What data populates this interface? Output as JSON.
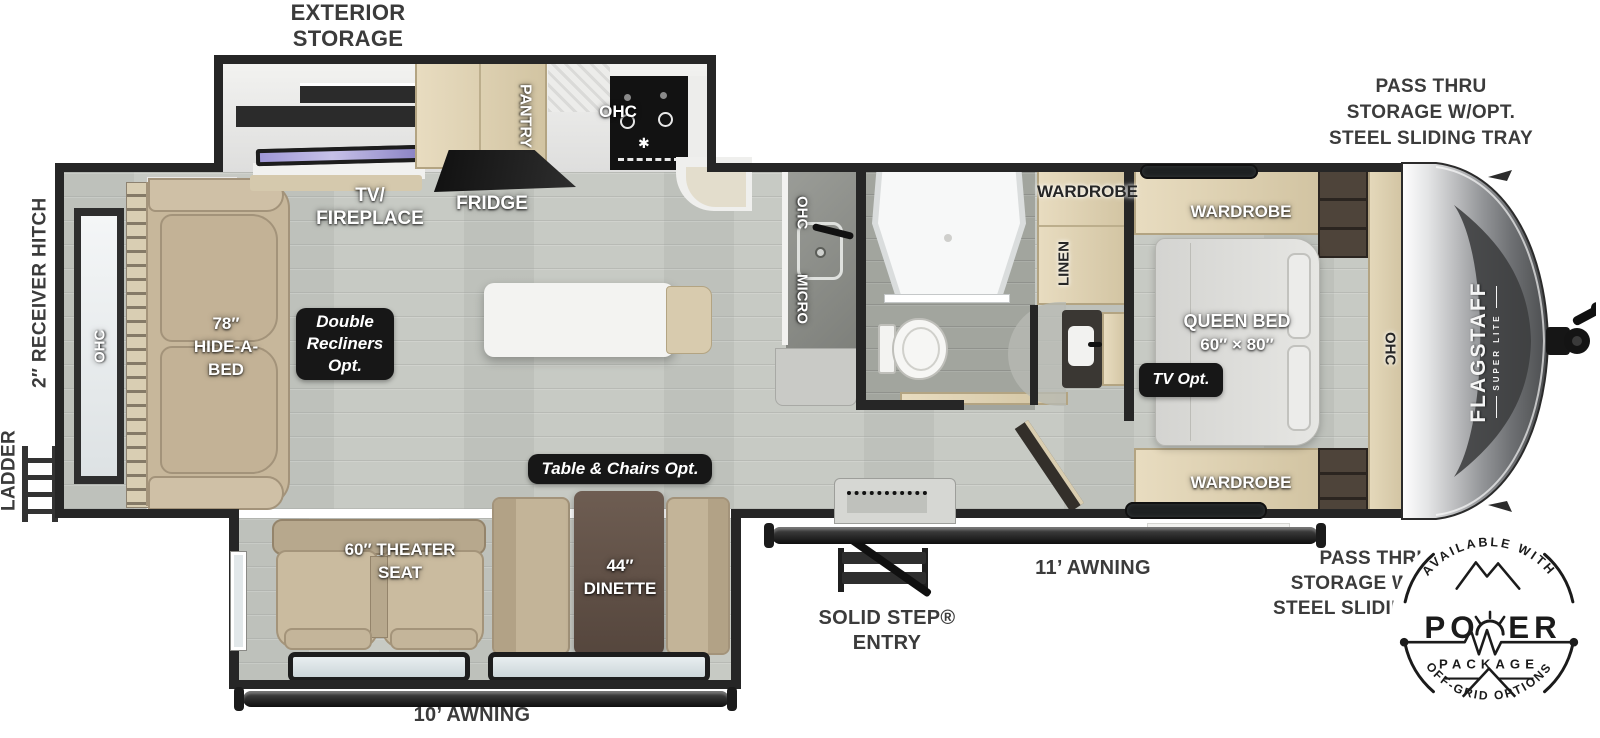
{
  "title": "FLAGSTAFF SUPER LITE travel trailer floorplan",
  "colors": {
    "wall": "#262626",
    "floor": "#c7cac4",
    "bath_floor": "#a2a59e",
    "cabinet_tan": "#ddd0b2",
    "upholstery_tan": "#c7b79b",
    "dinette_table": "#61514a",
    "badge_black": "#171717",
    "tv_screen_purple": "#9f97d6",
    "label_gray": "#3b3b3b"
  },
  "exterior": {
    "exterior_storage": [
      "EXTERIOR",
      "STORAGE"
    ],
    "pass_thru_top": [
      "PASS THRU",
      "STORAGE W/OPT.",
      "STEEL SLIDING TRAY"
    ],
    "pass_thru_bottom": [
      "PASS THRU",
      "STORAGE W/OPT.",
      "STEEL SLIDING TRAY"
    ],
    "ladder": "LADDER",
    "receiver_hitch": "2″ RECEIVER HITCH",
    "solid_step": [
      "SOLID STEP®",
      "ENTRY"
    ],
    "awning_11": "11’ AWNING",
    "awning_10": "10’ AWNING"
  },
  "living": {
    "ohc_rear": "OHC",
    "hide_a_bed": [
      "78″",
      "HIDE-A-",
      "BED"
    ],
    "tv_fireplace": [
      "TV/",
      "FIREPLACE"
    ],
    "fridge": "FRIDGE",
    "pantry": "PANTRY",
    "ohc_kitchen": "OHC",
    "ohc_counter": "OHC",
    "micro_counter": "MICRO",
    "double_recliners": [
      "Double",
      "Recliners",
      "Opt."
    ],
    "table_chairs": "Table & Chairs Opt.",
    "theater_seat": [
      "60″ THEATER",
      "SEAT"
    ],
    "dinette": [
      "44″",
      "DINETTE"
    ]
  },
  "bath": {
    "wardrobe": "WARDROBE",
    "linen": "LINEN"
  },
  "bedroom": {
    "wardrobe_top": "WARDROBE",
    "wardrobe_bottom": "WARDROBE",
    "queen_bed": [
      "QUEEN BED",
      "60″ × 80″"
    ],
    "tv_opt": "TV Opt.",
    "ohc": "OHC"
  },
  "brand": {
    "name": "FLAGSTAFF",
    "sub": "SUPER LITE"
  },
  "power_badge": {
    "arc_top": "AVAILABLE WITH",
    "word_left": "PO",
    "word_right": "ER",
    "package": "PACKAGE",
    "arc_bottom": "OFF-GRID OPTIONS"
  }
}
